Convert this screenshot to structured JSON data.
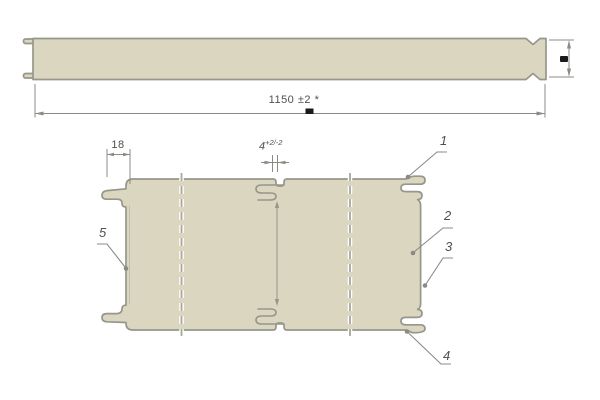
{
  "colors": {
    "background": "#ffffff",
    "panel_fill": "#dbd6c0",
    "panel_stroke": "#97968b",
    "line": "#8b8b85",
    "dash": "#a9a79c",
    "text": "#4f4f4b",
    "mark": "#1a1a1a"
  },
  "side_view": {
    "length_dimension": "1150 ±2 *"
  },
  "plan_view": {
    "tab_width_dimension": "18",
    "gap_dimension": {
      "value": "4",
      "tolerance": "+2/-2"
    },
    "callouts": [
      {
        "label": "1"
      },
      {
        "label": "2"
      },
      {
        "label": "3"
      },
      {
        "label": "4"
      },
      {
        "label": "5"
      }
    ]
  }
}
